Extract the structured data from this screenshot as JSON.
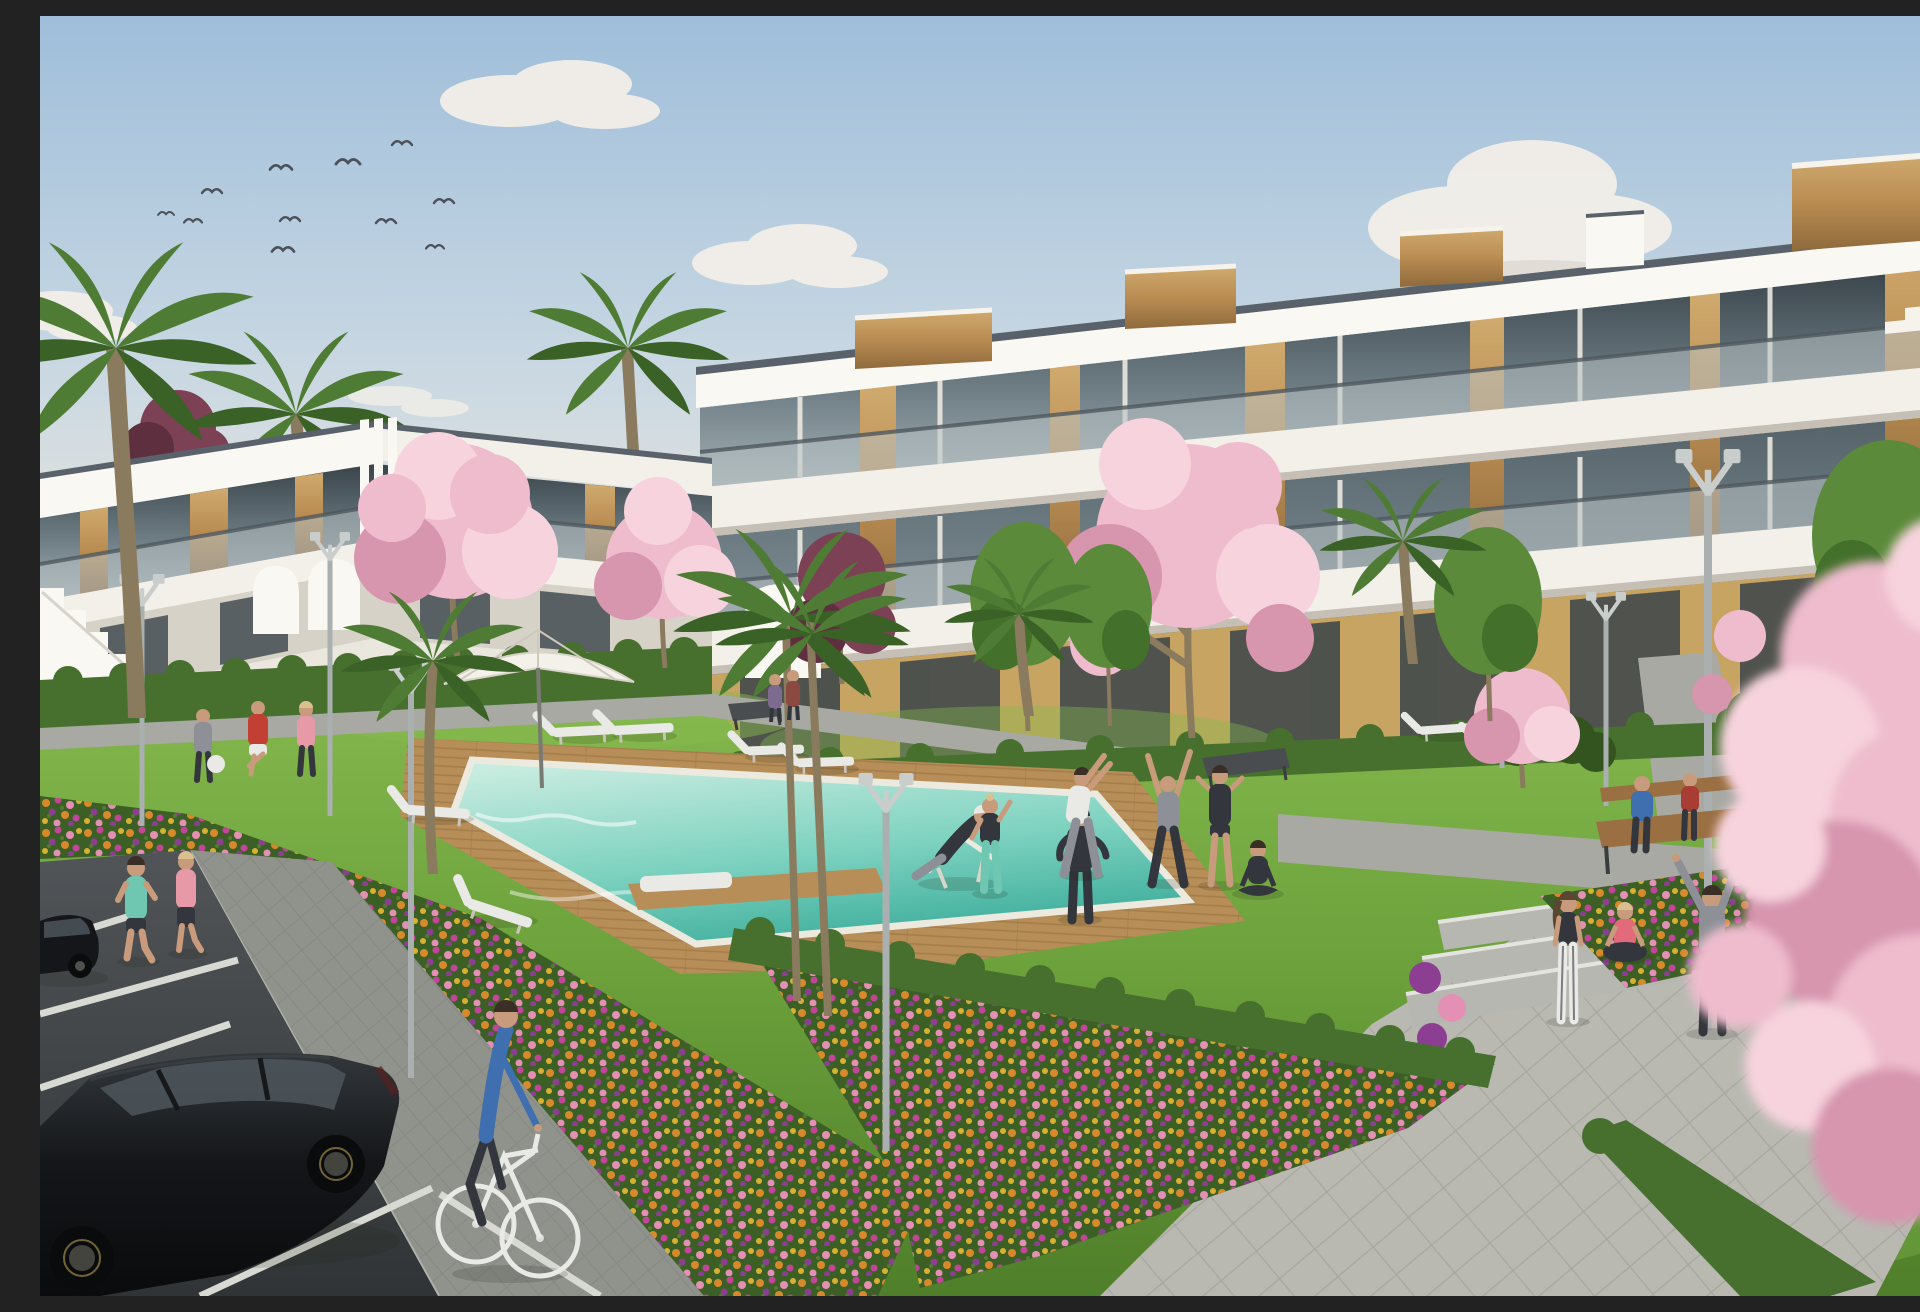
{
  "scene": {
    "type": "3d-architectural-render",
    "subject": "Modern white apartment complex with communal garden, swimming pool, lawns and parking, rendered on a sunny day",
    "elements": [
      "pale blue sky with scattered clouds and a flock of flying birds",
      "three-storey white apartment block with stacked balcony slabs, glass balustrades, dark glazing and vertical wood cladding on the right",
      "two-storey white apartment wing with wood panels, curved arches and an external stair on the left",
      "turquoise swimming pool edged with white coping and a wooden deck",
      "white sun loungers and a white parasol around the pool",
      "green lawns with palm trees, pink cherry-blossom trees, maroon and green ornamental trees",
      "colourful flower beds of orange, magenta, purple, pink and yellow blooms",
      "trimmed hedges along the building bases and paths",
      "grey paved footpaths, wide plaza with shallow steps and modern twin-arm street lamps",
      "dark asphalt parking area with white bay lines, a black hatchback and a black sedan",
      "people jogging, cycling, playing with a ball, stretching, doing yoga, lounging and sitting on benches",
      "blurred pink blossom branches in the right foreground"
    ]
  },
  "colors": {
    "sky_top": "#9fbeda",
    "sky_mid": "#c6d6e2",
    "sky_horizon": "#e9e6df",
    "cloud_white": "#f3efe8",
    "cloud_shadow": "#d9d2c8",
    "bird": "#4a5158",
    "building_white": "#f3f0ea",
    "building_white_bright": "#faf8f3",
    "building_shadow": "#d7d2c8",
    "building_under_shadow": "#b0aa9f",
    "roof_cap": "#59626a",
    "glass_dark": "#39444a",
    "glass_mid": "#6e7d84",
    "glass_light": "#a4b2b6",
    "balcony_glass": "#b9c3c4",
    "wood_panel": "#b98c52",
    "wood_dark": "#8f6a3c",
    "wood_light": "#d0aa6e",
    "ochre_wall": "#c7a462",
    "hedge_green": "#47702e",
    "hedge_dark": "#33531f",
    "lawn_green": "#6da23c",
    "lawn_light": "#85b94e",
    "lawn_shadow": "#4f7f2a",
    "pool_far": "#c9ece0",
    "pool_mid": "#7ed2c0",
    "pool_near": "#3fae9c",
    "pool_coping": "#eceadf",
    "deck_wood": "#b78d58",
    "deck_wood_dark": "#96713f",
    "path_gray": "#a8a9a2",
    "path_light": "#b9b9b2",
    "sidewalk_gray": "#90928c",
    "step_gray": "#b6b7b1",
    "asphalt": "#515558",
    "asphalt_dark": "#303436",
    "stall_line": "#d8d9d2",
    "car_black": "#141619",
    "car_glass": "#4e565c",
    "rim_accent": "#b9a24e",
    "blossom_pink": "#eebccd",
    "blossom_light": "#f7d3de",
    "blossom_deep": "#d795ae",
    "maroon_tree": "#7c4155",
    "maroon_dark": "#5d2f3f",
    "palm_green": "#4f7c35",
    "palm_dark": "#3a6126",
    "tree_green": "#5b8a3a",
    "tree_green_dark": "#43702a",
    "trunk_brown": "#8a7a5e",
    "trunk_dark": "#66583f",
    "flower_orange": "#d8892c",
    "flower_magenta": "#c2459a",
    "flower_purple": "#8c3f92",
    "flower_pink": "#e390b4",
    "flower_yellow": "#d9b132",
    "bed_base": "#3c5f26",
    "lamp_metal": "#c9cdcc",
    "lamp_pole": "#aab0b0",
    "bench_wood": "#9a6f42",
    "bench_dark": "#4a4d50",
    "skin": "#c79b7c",
    "hair_dark": "#3a2e26",
    "hair_blonde": "#d9c08e",
    "shirt_teal": "#6fc7b2",
    "shirt_pink": "#e899a7",
    "shirt_red": "#c23f33",
    "shirt_blue": "#3f6fae",
    "shirt_coral": "#e26a7b",
    "outfit_gray": "#8d9096",
    "outfit_dark": "#33363c",
    "outfit_white": "#e9e9e6",
    "umbrella_white": "#f4f1ea"
  }
}
